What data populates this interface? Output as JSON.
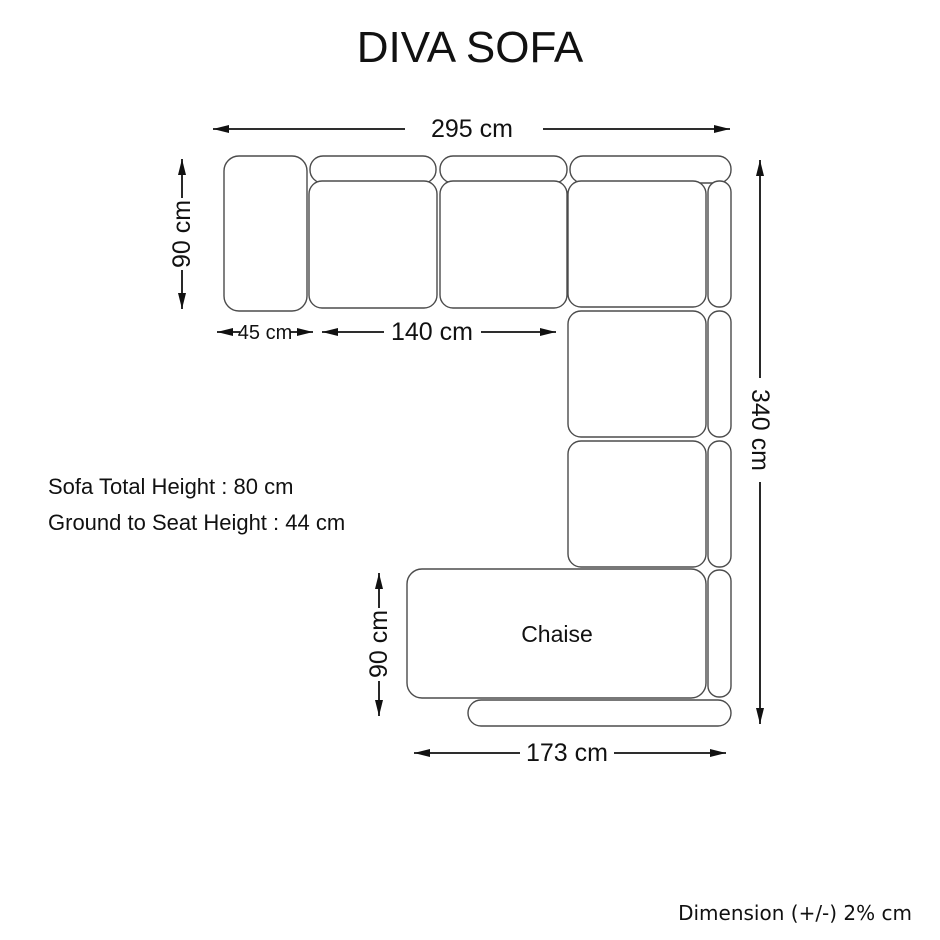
{
  "title": "DIVA SOFA",
  "diagram": {
    "chaise_label": "Chaise",
    "dimensions": {
      "total_width": "295 cm",
      "left_depth": "90 cm",
      "armrest_width": "45 cm",
      "seat_span": "140 cm",
      "total_length": "340 cm",
      "chaise_depth": "90 cm",
      "chaise_width": "173 cm"
    }
  },
  "specs": {
    "total_height": "Sofa Total Height : 80 cm",
    "ground_to_seat": "Ground to Seat Height : 44 cm"
  },
  "footer": {
    "tolerance_note": "Dimension (+/-) 2% cm"
  },
  "colors": {
    "background": "#ffffff",
    "sofa_outline": "#4b4b4b",
    "dimension_lines": "#111111",
    "text": "#111111"
  }
}
